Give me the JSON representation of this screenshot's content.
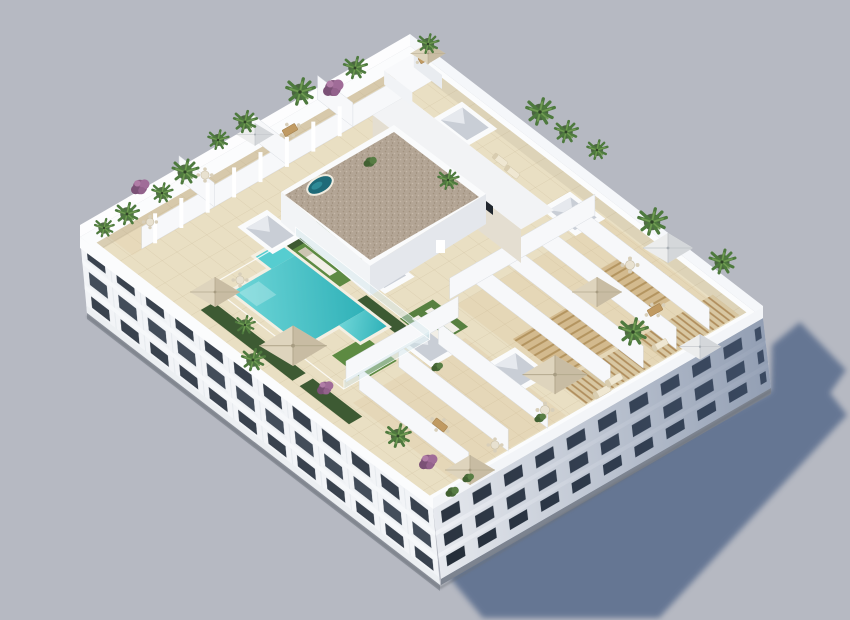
{
  "scene": {
    "description": "Aerial 3D architectural render of a white apartment block with a landscaped rooftop terrace: central turquoise pool, green lawns, private terraces with parasols and palm trees, white parapet walls and a long cast shadow on a plain grey ground.",
    "type": "architectural-3d-render",
    "visible_text": []
  },
  "palette": {
    "ground": "#b6b9c2",
    "cast_shadow": "#5f7190",
    "facade_lit": "#f2f4f7",
    "facade_shaded": "#e4e7ee",
    "window_glass": "#39424e",
    "roof_tile": "#e9dfc3",
    "pool_water": "#45c2c6",
    "lawn_green": "#5d8a42",
    "hedge_green": "#3d5a33",
    "parasol_tan": "#ddd3bd",
    "pergola_wood": "#d8c7a2",
    "gravel_roof": "#b3a595",
    "purple_bush": "#93628c"
  },
  "inventory": {
    "building_floors_visible": 3,
    "pools": 1,
    "hot_tubs": 1,
    "skylights": 6,
    "parasols": 9,
    "palm_trees": 19,
    "purple_bushes": 4,
    "sun_loungers": 7,
    "dining_sets": 10,
    "penthouse_structures": 2,
    "pergola_sections": 2
  }
}
